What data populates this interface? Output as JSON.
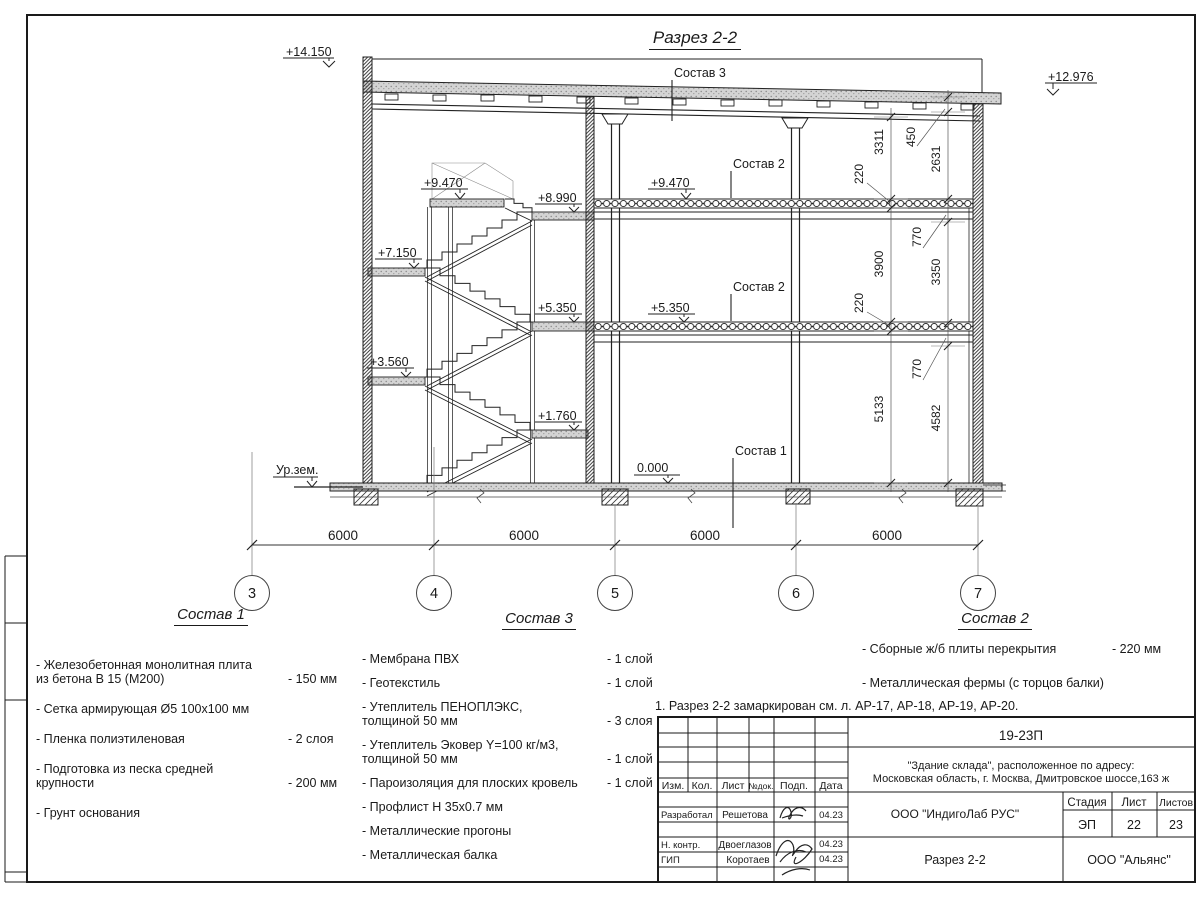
{
  "sheet": {
    "title": "Разрез 2-2",
    "note": "1. Разрез 2-2 замаркирован см. л. АР-17, АР-18, АР-19, АР-20.",
    "ground_label": "Ур.зем."
  },
  "section_labels": {
    "sostav1": "Состав 1",
    "sostav2": "Состав 2",
    "sostav3": "Состав 3"
  },
  "elevations": [
    "+14.150",
    "+12.976",
    "+9.470",
    "+8.990",
    "+7.150",
    "+5.350",
    "+3.560",
    "+1.760",
    "+9.470",
    "+5.350",
    "0.000"
  ],
  "axis_labels": [
    "3",
    "4",
    "5",
    "6",
    "7"
  ],
  "span_dims": [
    "6000",
    "6000",
    "6000",
    "6000"
  ],
  "height_dims_inner": [
    "3311",
    "220",
    "3900",
    "220",
    "5133"
  ],
  "height_dims_outer": [
    "450",
    "2631",
    "770",
    "3350",
    "770",
    "4582"
  ],
  "compositions": {
    "c1": {
      "title": "Состав 1",
      "items": [
        {
          "text": "- Железобетонная  монолитная плита\nиз бетона В 15 (М200)",
          "value": "- 150 мм"
        },
        {
          "text": "- Сетка армирующая Ø5 100х100 мм",
          "value": ""
        },
        {
          "text": "- Пленка полиэтиленовая",
          "value": "-  2 слоя"
        },
        {
          "text": "- Подготовка из песка средней\nкрупности",
          "value": "- 200 мм"
        },
        {
          "text": "- Грунт основания",
          "value": ""
        }
      ]
    },
    "c3": {
      "title": "Состав 3",
      "items": [
        {
          "text": "- Мембрана ПВХ",
          "value": "- 1 слой"
        },
        {
          "text": "- Геотекстиль",
          "value": "- 1 слой"
        },
        {
          "text": "- Утеплитель ПЕНОПЛЭКС,\nтолщиной 50 мм",
          "value": "- 3 слоя"
        },
        {
          "text": "- Утеплитель Эковер Y=100 кг/м3,\nтолщиной 50 мм",
          "value": "- 1 слой"
        },
        {
          "text": "- Пароизоляция для плоских кровель",
          "value": "- 1 слой"
        },
        {
          "text": "- Профлист Н 35х0.7 мм",
          "value": ""
        },
        {
          "text": "- Металлические прогоны",
          "value": ""
        },
        {
          "text": "- Металлическая балка",
          "value": ""
        }
      ]
    },
    "c2": {
      "title": "Состав 2",
      "items": [
        {
          "text": "- Сборные ж/б плиты перекрытия",
          "value": "- 220 мм"
        },
        {
          "text": "- Металлическая фермы (с торцов балки)",
          "value": ""
        }
      ]
    }
  },
  "stamp": {
    "doc_number": "19-23П",
    "object_line1": "\"Здание склада\", расположенное по адресу:",
    "object_line2": "Московская область, г. Москва, Дмитровское шоссе,163 ж",
    "company": "ООО \"ИндигоЛаб РУС\"",
    "drawing_name": "Разрез 2-2",
    "contractor": "ООО \"Альянс\"",
    "stage_label": "Стадия",
    "sheet_label": "Лист",
    "sheets_label": "Листов",
    "stage": "ЭП",
    "sheet_no": "22",
    "sheets_total": "23",
    "cols": [
      "Изм.",
      "Кол.",
      "Лист",
      "№док.",
      "Подп.",
      "Дата"
    ],
    "rows": [
      {
        "role": "Разработал",
        "name": "Решетова",
        "date": "04.23"
      },
      {
        "role": "Н. контр.",
        "name": "Двоеглазов",
        "date": "04.23"
      },
      {
        "role": "ГИП",
        "name": "Коротаев",
        "date": "04.23"
      }
    ]
  }
}
